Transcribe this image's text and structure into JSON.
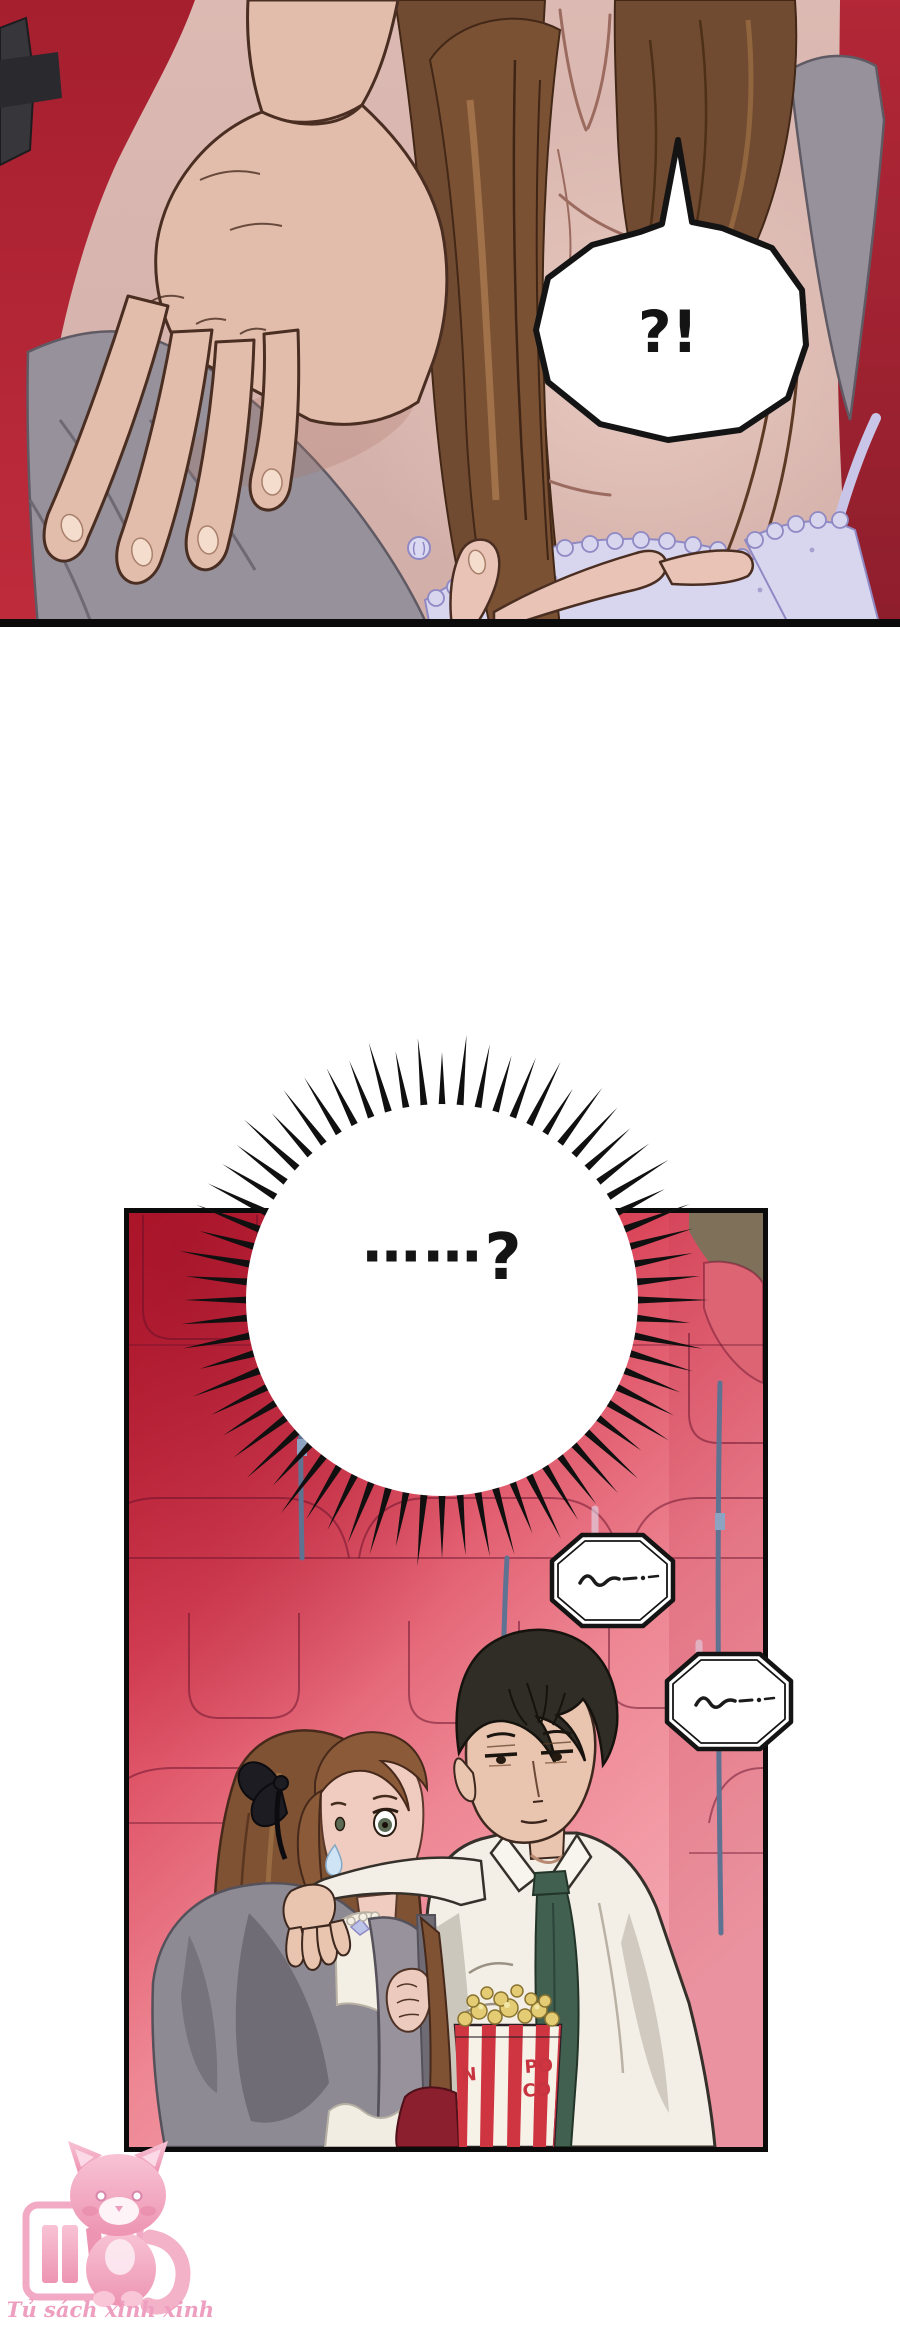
{
  "page": {
    "width": 900,
    "height": 2326,
    "background": "#ffffff"
  },
  "top_panel": {
    "speech_bubble": {
      "text": "?!"
    },
    "colors": {
      "skin": "#d8b7b1",
      "red_backdrop": "#b12a38",
      "hair_brown": "#714b31",
      "cardigan_gray": "#96919a",
      "lace_lavender": "#d8d5ee"
    }
  },
  "burst_bubble": {
    "dots": "……",
    "question_mark": "?"
  },
  "theater_panel": {
    "colors": {
      "seats_top_red": "#c5182e",
      "seats_bottom_pink": "#f5abb5",
      "seam_blue": "#5e7292",
      "wall_corner_tan": "#7e7059",
      "tie_green": "#41604f",
      "bucket_red": "#cf3540"
    },
    "mumble_bubbles": [
      {
        "scribble": "~—··"
      },
      {
        "scribble": "~—··"
      }
    ],
    "popcorn_bucket": {
      "letter_left": "N",
      "letters_right_top": "PO",
      "letters_right_bottom": "CO"
    }
  },
  "watermark": {
    "caption": "Tủ sách xinh xinh",
    "icon": "pink-cat-bookshelf",
    "color": "#ee9fc0"
  }
}
